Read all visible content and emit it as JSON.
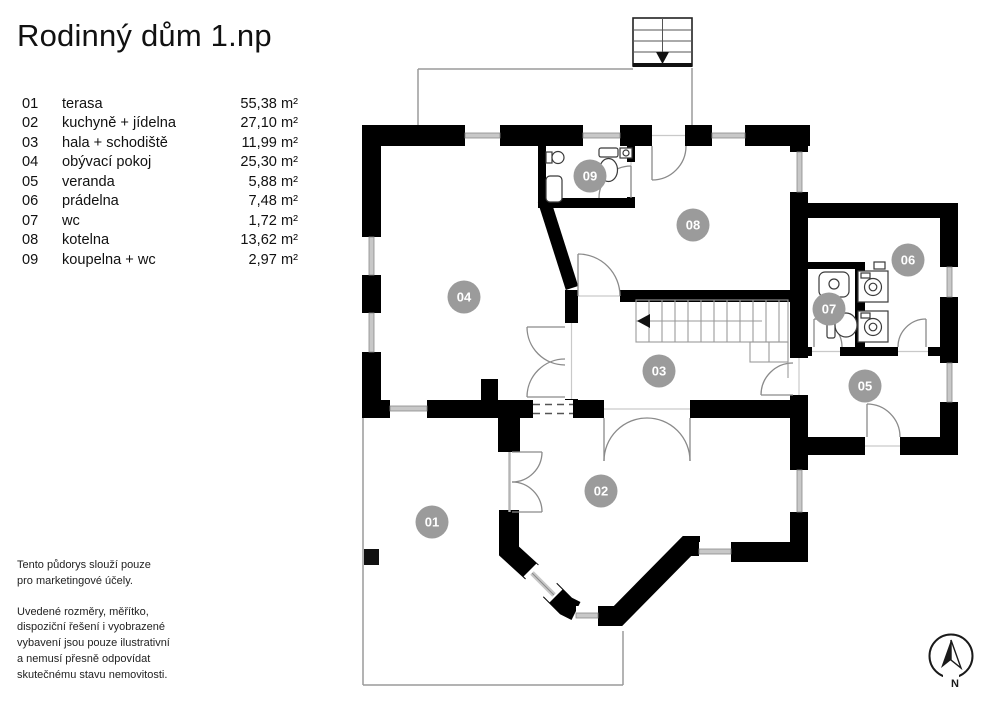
{
  "title": "Rodinný dům 1.np",
  "legend": {
    "rooms": [
      {
        "number": "01",
        "name": "terasa",
        "area": "55,38 m²"
      },
      {
        "number": "02",
        "name": "kuchyně + jídelna",
        "area": "27,10 m²"
      },
      {
        "number": "03",
        "name": "hala + schodiště",
        "area": "11,99 m²"
      },
      {
        "number": "04",
        "name": "obývací pokoj",
        "area": "25,30 m²"
      },
      {
        "number": "05",
        "name": "veranda",
        "area": "5,88 m²"
      },
      {
        "number": "06",
        "name": "prádelna",
        "area": "7,48 m²"
      },
      {
        "number": "07",
        "name": "wc",
        "area": "1,72 m²"
      },
      {
        "number": "08",
        "name": "kotelna",
        "area": "13,62 m²"
      },
      {
        "number": "09",
        "name": "koupelna + wc",
        "area": "2,97 m²"
      }
    ]
  },
  "disclaimer": {
    "para1": "Tento půdorys slouží pouze\npro marketingové účely.",
    "para2": "Uvedené rozměry, měřítko,\ndispoziční řešení i vyobrazené\nvybavení jsou pouze ilustrativní\na nemusí přesně odpovídat\nskutečnému stavu nemovitosti."
  },
  "compass": {
    "label": "N"
  },
  "badges": [
    {
      "label": "01",
      "x": 432,
      "y": 522
    },
    {
      "label": "02",
      "x": 601,
      "y": 491
    },
    {
      "label": "03",
      "x": 659,
      "y": 371
    },
    {
      "label": "04",
      "x": 464,
      "y": 297
    },
    {
      "label": "05",
      "x": 865,
      "y": 386
    },
    {
      "label": "06",
      "x": 908,
      "y": 260
    },
    {
      "label": "07",
      "x": 829,
      "y": 309
    },
    {
      "label": "08",
      "x": 693,
      "y": 225
    },
    {
      "label": "09",
      "x": 590,
      "y": 176
    }
  ],
  "colors": {
    "wall": "#000000",
    "badge_fill": "#9b9b9b",
    "badge_text": "#ffffff",
    "window_band": "#c8c8c8",
    "thin_outline": "#9a9a9a"
  }
}
